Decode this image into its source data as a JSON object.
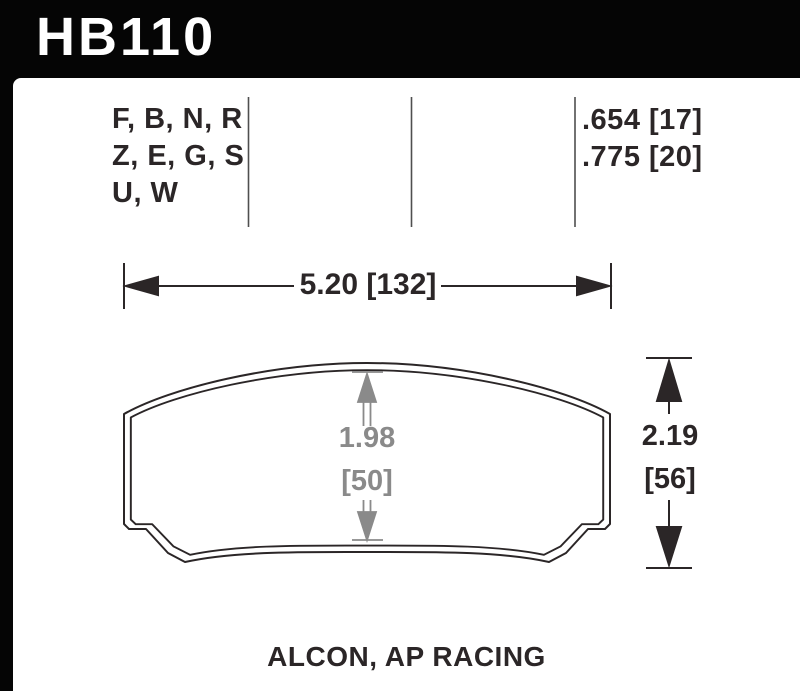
{
  "header": {
    "part_number": "HB110"
  },
  "compound_table": {
    "compound_rows": [
      "F, B, N, R",
      "Z, E, G, S",
      "U, W"
    ],
    "thickness_rows": [
      ".654 [17]",
      ".775 [20]"
    ]
  },
  "dimensions": {
    "width": "5.20 [132]",
    "height_in": "2.19",
    "height_mm": "[56]",
    "pad_inner_in": "1.98",
    "pad_inner_mm": "[50]"
  },
  "footer": {
    "applications": "ALCON, AP RACING"
  },
  "colors": {
    "header_bg": "#050505",
    "panel_bg": "#ffffff",
    "line_black": "#2b2627",
    "dimension_gray": "#8a8a8a",
    "separator_gray": "#4f4f4f"
  }
}
